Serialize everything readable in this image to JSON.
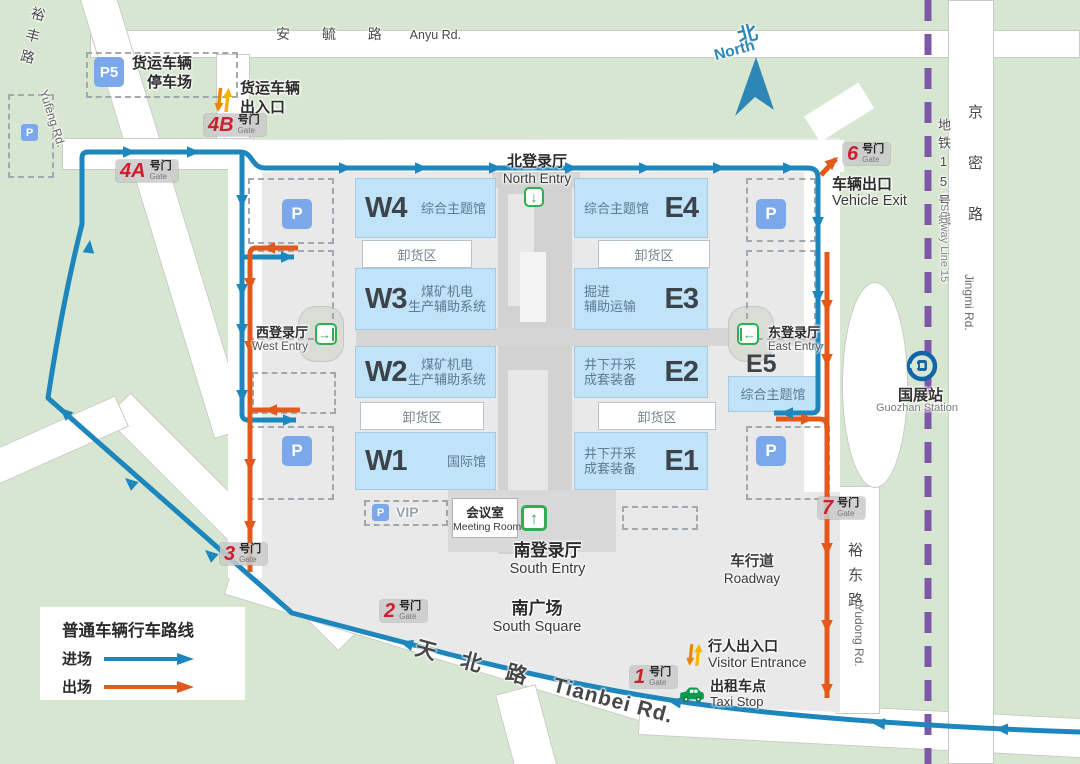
{
  "legend": {
    "title": "普通车辆行车路线",
    "enter": "进场",
    "exit": "出场"
  },
  "compass": {
    "zh": "北",
    "en": "North"
  },
  "roads": {
    "anyu_zh": "安 毓 路",
    "anyu_en": "Anyu Rd.",
    "yufeng_zh": "裕丰路",
    "yufeng_en": "Yufeng Rd.",
    "tianbei_zh": "天 北 路",
    "tianbei_en": "Tianbei Rd.",
    "jingmi_zh": "京密路",
    "jingmi_en": "Jingmi Rd.",
    "yudong_zh": "裕东路",
    "yudong_en": "Yudong Rd.",
    "subway_zh": "地铁15号线",
    "subway_en": "Subway Line 15"
  },
  "station": {
    "zh": "国展站",
    "en": "Guozhan Station"
  },
  "entries": {
    "north_zh": "北登录厅",
    "north_en": "North Entry",
    "south_zh": "南登录厅",
    "south_en": "South Entry",
    "west_zh": "西登录厅",
    "west_en": "West Entry",
    "east_zh": "东登录厅",
    "east_en": "East Entry"
  },
  "halls": [
    {
      "code": "W4",
      "l1": "综合主题馆",
      "l2": ""
    },
    {
      "code": "E4",
      "l1": "综合主题馆",
      "l2": ""
    },
    {
      "code": "W3",
      "l1": "煤矿机电",
      "l2": "生产辅助系统"
    },
    {
      "code": "E3",
      "l1": "掘进",
      "l2": "辅助运输"
    },
    {
      "code": "W2",
      "l1": "煤矿机电",
      "l2": "生产辅助系统"
    },
    {
      "code": "E2",
      "l1": "井下开采",
      "l2": "成套装备"
    },
    {
      "code": "W1",
      "l1": "国际馆",
      "l2": ""
    },
    {
      "code": "E1",
      "l1": "井下开采",
      "l2": "成套装备"
    },
    {
      "code": "E5",
      "l1": "综合主题馆",
      "l2": ""
    }
  ],
  "unloading": "卸货区",
  "gates": {
    "g1": "1",
    "g2": "2",
    "g3": "3",
    "g4a": "4A",
    "g4b": "4B",
    "g6": "6",
    "g7": "7",
    "suffix": "号门",
    "sub": "Gate"
  },
  "labels": {
    "freight_parking_1": "货运车辆",
    "freight_parking_2": "停车场",
    "freight_gate_1": "货运车辆",
    "freight_gate_2": "出入口",
    "vehicle_exit_zh": "车辆出口",
    "vehicle_exit_en": "Vehicle Exit",
    "south_square_zh": "南广场",
    "south_square_en": "South Square",
    "roadway_zh": "车行道",
    "roadway_en": "Roadway",
    "visitor_zh": "行人出入口",
    "visitor_en": "Visitor Entrance",
    "taxi_zh": "出租车点",
    "taxi_en": "Taxi Stop",
    "meeting_zh": "会议室",
    "meeting_en": "Meeting Room",
    "vip": "VIP",
    "p": "P",
    "p5": "P5"
  },
  "colors": {
    "enter": "#1d87bd",
    "exit": "#e2591b",
    "hall": "#c0e3f8",
    "subway_line": "#7d58a8",
    "gate_red": "#cf1f2e",
    "parking_blue": "#7aa8ea",
    "entry_green": "#2fae53",
    "taxi_green": "#0d9a4e",
    "compass_blue": "#2d87b6",
    "metro_logo": "#1066a9"
  }
}
